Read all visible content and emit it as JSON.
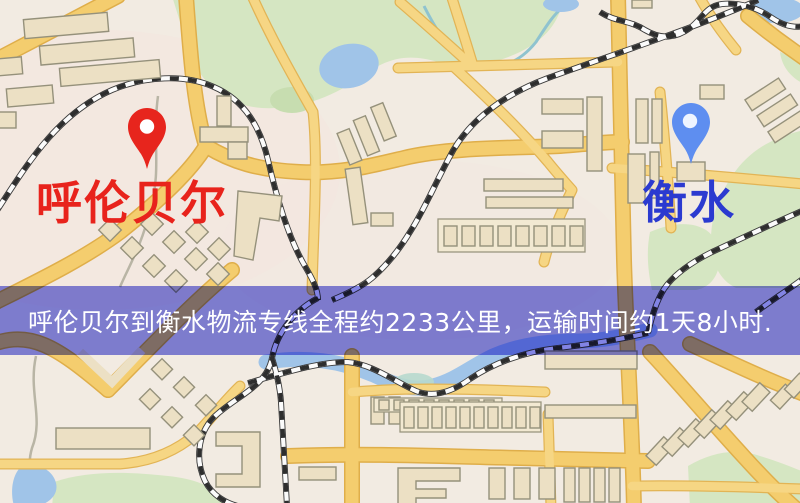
{
  "page": {
    "width_px": 800,
    "height_px": 503,
    "kind": "logistics route map image"
  },
  "map": {
    "origin": {
      "name": "呼伦贝尔",
      "marker": "red-pin",
      "marker_color": "#e7251d",
      "marker_hole_color": "#ffffff",
      "label_color": "#e8231c"
    },
    "destination": {
      "name": "衡水",
      "marker": "blue-pin",
      "marker_color": "#5e8ef0",
      "marker_hole_color": "#eef4ff",
      "label_color": "#2b3ad0"
    },
    "banner": {
      "text": "呼伦贝尔到衡水物流专线全程约2233公里，运输时间约1天8小时.",
      "text_color": "#ffffff",
      "overlay_color": "#8486e8"
    },
    "route_facts": {
      "distance_km": "2233",
      "transport_time": "1天8小时"
    },
    "palette": {
      "background": "#f2ebe2",
      "road": "#f4cd6e",
      "building": "#ece0c4",
      "park": "#d5e6c2",
      "water": "#a0c4e8",
      "railway": "#2e2e2e"
    }
  }
}
